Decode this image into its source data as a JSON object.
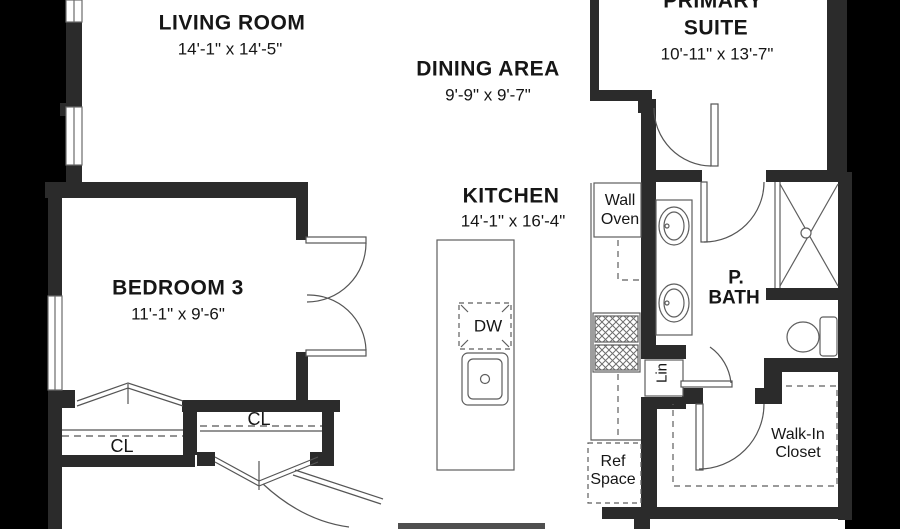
{
  "floorplan": {
    "rooms": {
      "living_room": {
        "name": "LIVING ROOM",
        "dims": "14'-1\" x 14'-5\""
      },
      "dining_area": {
        "name": "DINING AREA",
        "dims": "9'-9\" x 9'-7\""
      },
      "primary_suite": {
        "name_line1": "PRIMARY",
        "name_line2": "SUITE",
        "dims": "10'-11\" x 13'-7\""
      },
      "kitchen": {
        "name": "KITCHEN",
        "dims": "14'-1\" x 16'-4\""
      },
      "bedroom_3": {
        "name": "BEDROOM 3",
        "dims": "11'-1\" x 9'-6\""
      },
      "primary_bath": {
        "name_line1": "P.",
        "name_line2": "BATH"
      },
      "walk_in_closet": {
        "name_line1": "Walk-In",
        "name_line2": "Closet"
      }
    },
    "labels": {
      "wall_oven_line1": "Wall",
      "wall_oven_line2": "Oven",
      "dishwasher": "DW",
      "ref_line1": "Ref",
      "ref_line2": "Space",
      "linen": "Lin",
      "closet_left": "CL",
      "closet_right": "CL"
    },
    "colors": {
      "background": "#000000",
      "floor": "#ffffff",
      "wall": "#2b2b2b",
      "line": "#5e5e5e",
      "text": "#161616"
    }
  }
}
